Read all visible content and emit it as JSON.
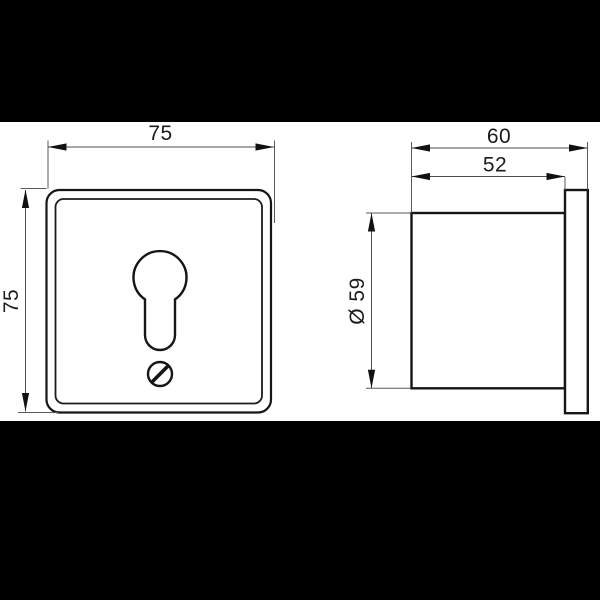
{
  "dimensions": {
    "front_width": "75",
    "front_height": "75",
    "side_overall_depth": "60",
    "side_body_depth": "52",
    "side_diameter": "Ø 59"
  },
  "colors": {
    "letterbox": "#000000",
    "canvas": "#ffffff",
    "line": "#1a1a1a"
  }
}
